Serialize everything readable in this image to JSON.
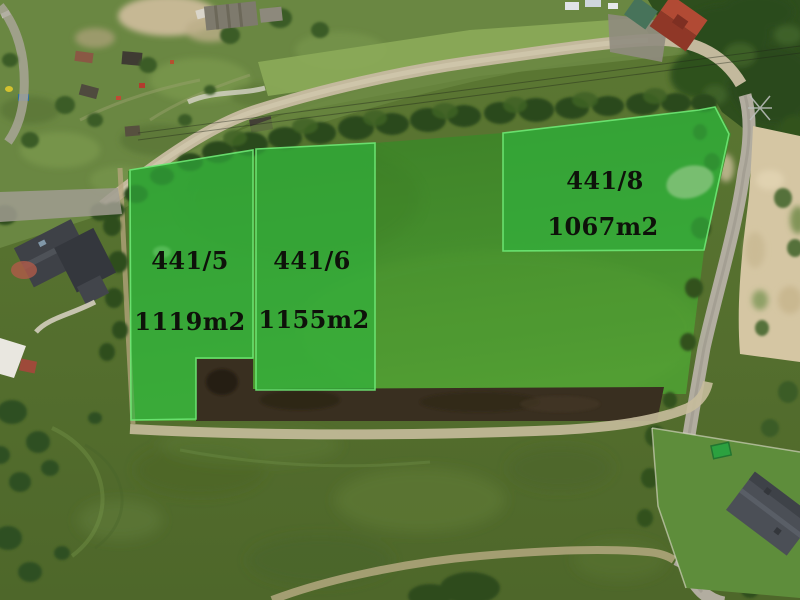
{
  "parcels": [
    {
      "id": "441/5",
      "area": "1119m2"
    },
    {
      "id": "441/6",
      "area": "1155m2"
    },
    {
      "id": "441/8",
      "area": "1067m2"
    }
  ],
  "colors": {
    "parcel_overlay_green": "#2fb43d",
    "parcel_border_green": "#6ee874",
    "label_text": "#0e120a"
  }
}
